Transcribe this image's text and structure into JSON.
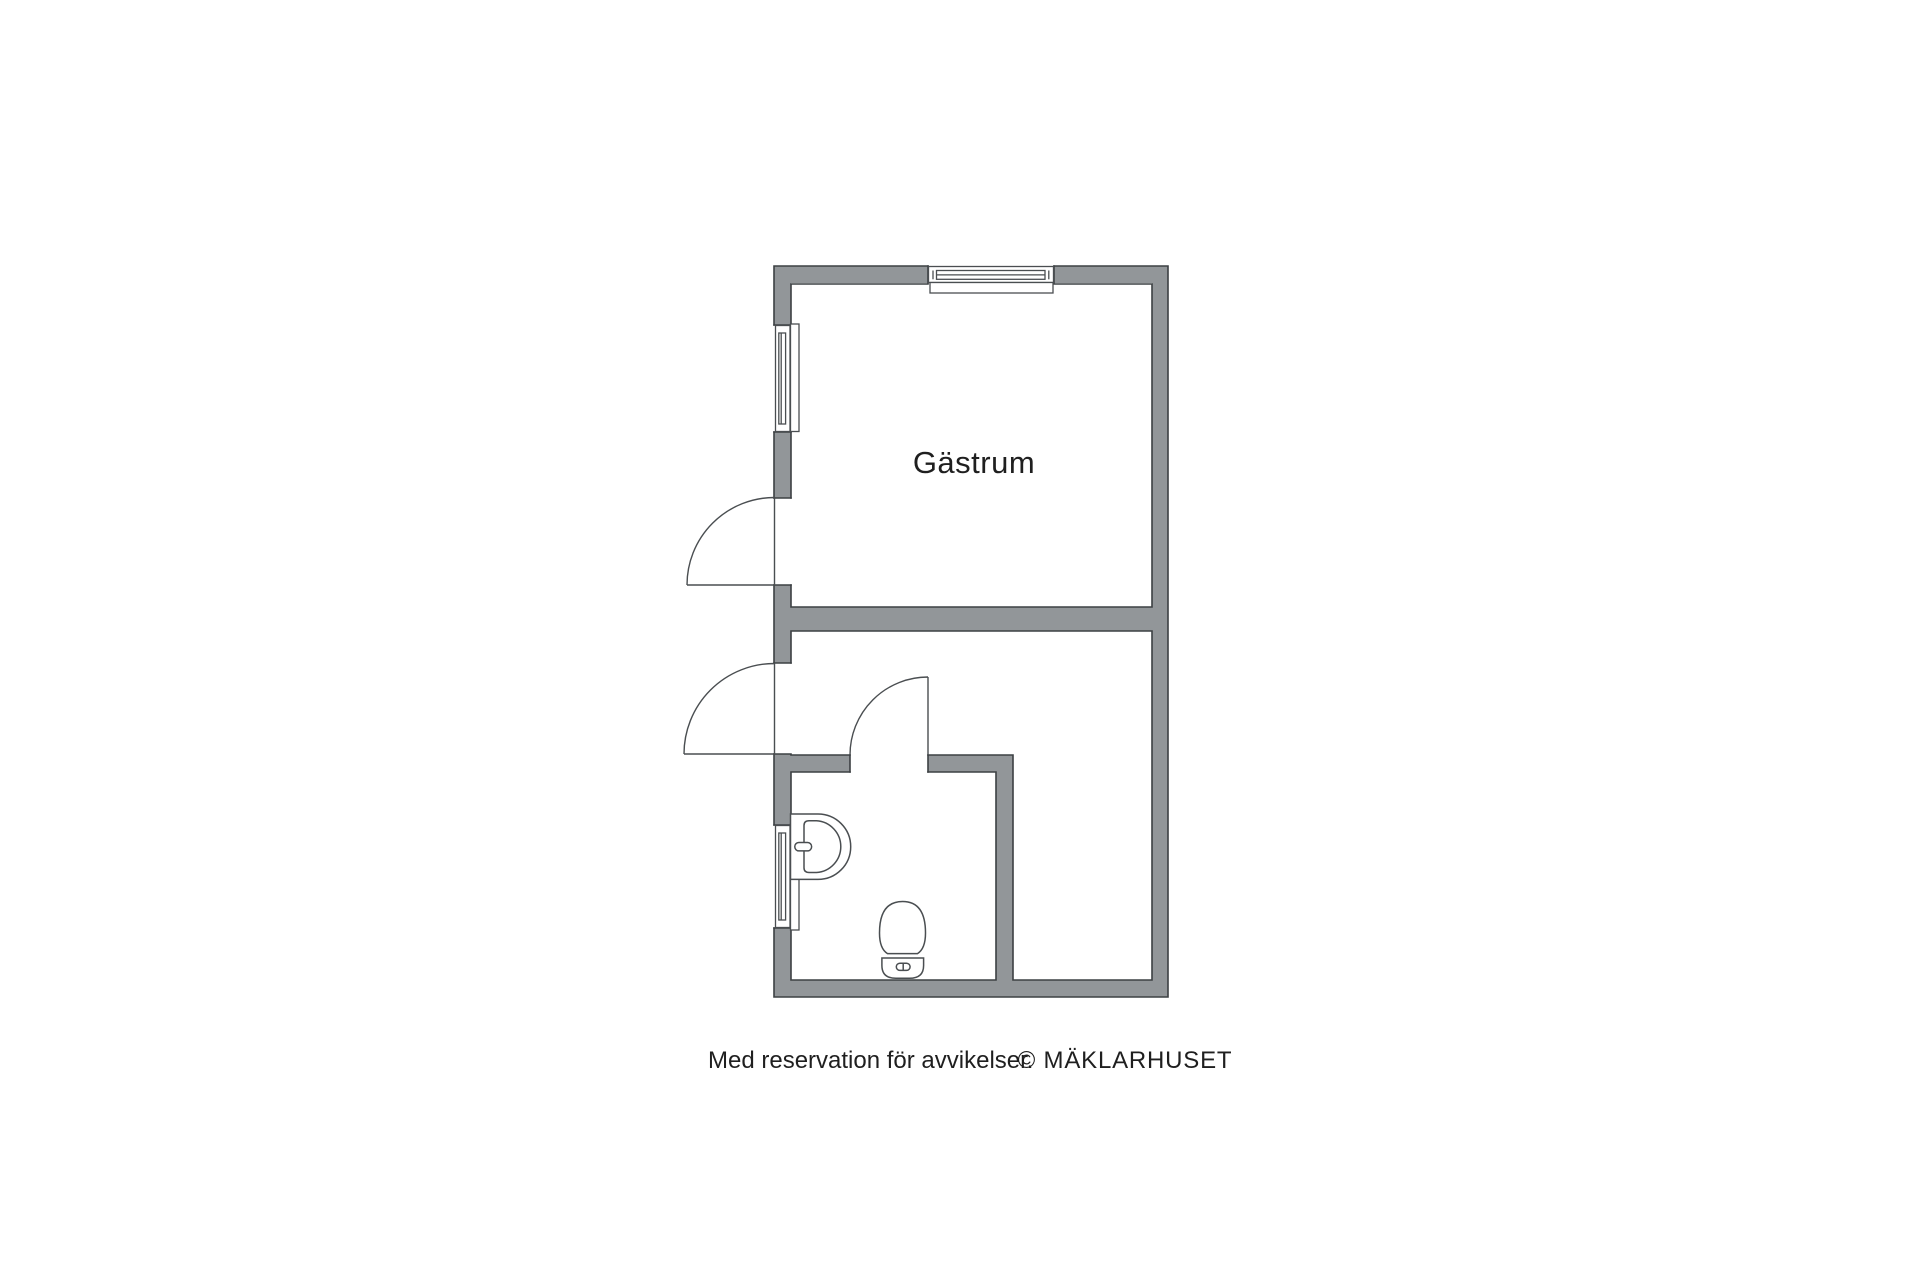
{
  "floorplan": {
    "room_label": "Gästrum",
    "colors": {
      "wall_fill": "#929699",
      "wall_outline": "#3c4043",
      "feature_line": "#4a4e51",
      "fixture_fill": "#ffffff",
      "text": "#1f1f1f",
      "background": "#ffffff"
    },
    "features": {
      "windows": [
        "top-window",
        "left-upper-window",
        "bathroom-window"
      ],
      "doors": [
        "gastrum-door",
        "entry-door",
        "bathroom-door"
      ],
      "fixtures": [
        "sink-icon",
        "toilet-icon"
      ]
    }
  },
  "footer": {
    "disclaimer": "Med reservation för avvikelser.",
    "copyright": "© MÄKLARHUSET"
  }
}
